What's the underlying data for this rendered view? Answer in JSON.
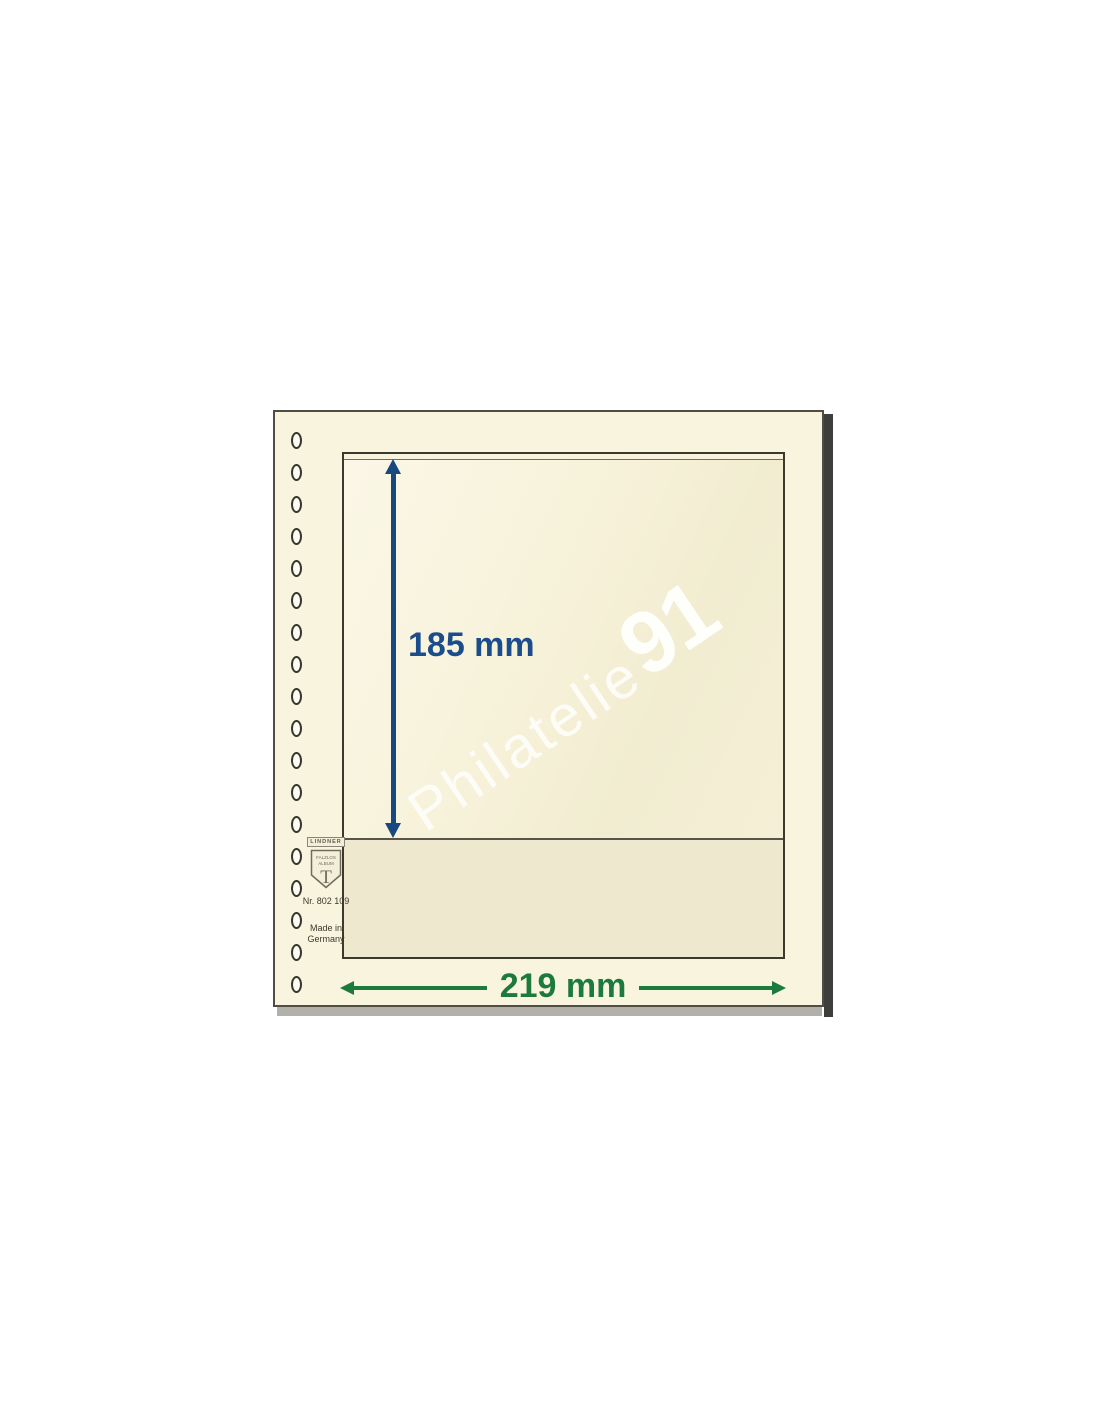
{
  "photo": {
    "watermark": {
      "script": "Philatelie",
      "bold": "91"
    },
    "vertical_dimension": {
      "label": "185 mm"
    },
    "horizontal_dimension": {
      "label": "219 mm"
    },
    "brand": {
      "name": "LINDNER",
      "shield_line1": "FALZLOS",
      "shield_line2": "ALBUM",
      "shield_monogram": "T",
      "product_number": "Nr. 802 109",
      "origin": "Made in\nGermany"
    },
    "hole_count": 18,
    "colors": {
      "page_cream": "#f8f4de",
      "pocket_cream": "#f4efd5",
      "pocket_lower_cream": "#eee8cf",
      "dimension_blue": "#17497f",
      "dimension_green": "#1c7a3d",
      "watermark_white": "#ffffff",
      "shadow_dark": "#3e3e3c",
      "shadow_gray": "#b2b0aa",
      "background_white": "#ffffff"
    }
  }
}
